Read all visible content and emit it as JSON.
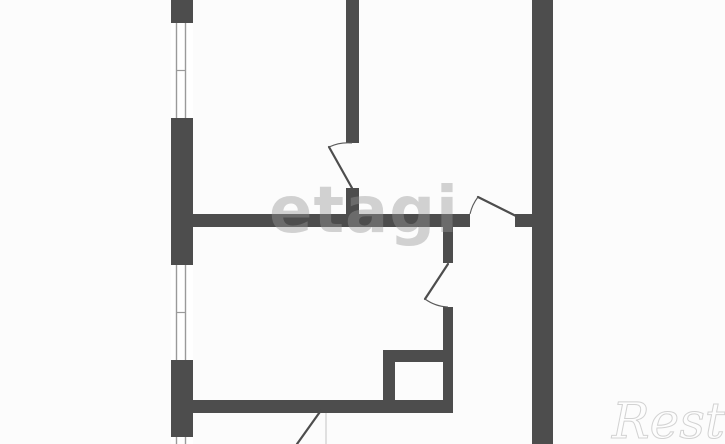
{
  "canvas": {
    "width": 725,
    "height": 444,
    "background": "#fcfcfc"
  },
  "palette": {
    "wall": "#4d4d4d",
    "door": "#4d4d4d",
    "arc": "#5a5a5a",
    "window_fill": "#ffffff",
    "window_glass": "#9a9a9a",
    "faint_line": "#c4c4c4",
    "watermark_center": "rgba(150,150,150,0.42)",
    "watermark_corner_fill": "#fdfdfd",
    "watermark_corner_stroke": "#d2d2d2"
  },
  "watermarks": {
    "center": "etagi",
    "corner": "Restate"
  },
  "floorplan": {
    "walls": [
      {
        "x": 171,
        "y": 0,
        "w": 22,
        "h": 23
      },
      {
        "x": 171,
        "y": 118,
        "w": 22,
        "h": 147
      },
      {
        "x": 171,
        "y": 360,
        "w": 22,
        "h": 77
      },
      {
        "x": 346,
        "y": 0,
        "w": 13,
        "h": 143
      },
      {
        "x": 346,
        "y": 188,
        "w": 13,
        "h": 39
      },
      {
        "x": 532,
        "y": 0,
        "w": 21,
        "h": 444
      },
      {
        "x": 193,
        "y": 214,
        "w": 277,
        "h": 13
      },
      {
        "x": 515,
        "y": 214,
        "w": 17,
        "h": 13
      },
      {
        "x": 443,
        "y": 227,
        "w": 10,
        "h": 36
      },
      {
        "x": 443,
        "y": 307,
        "w": 10,
        "h": 106
      },
      {
        "x": 383,
        "y": 350,
        "w": 12,
        "h": 50
      },
      {
        "x": 383,
        "y": 350,
        "w": 70,
        "h": 12
      },
      {
        "x": 193,
        "y": 400,
        "w": 260,
        "h": 13
      }
    ],
    "windows": [
      {
        "x": 171,
        "y": 23,
        "w": 22,
        "h": 95
      },
      {
        "x": 171,
        "y": 265,
        "w": 22,
        "h": 95
      },
      {
        "x": 171,
        "y": 437,
        "w": 22,
        "h": 7
      }
    ],
    "glass_offsets": [
      5.5,
      14.5
    ],
    "door_leaves": [
      {
        "x1": 352,
        "y1": 188,
        "x2": 329,
        "y2": 147
      },
      {
        "x1": 516,
        "y1": 216,
        "x2": 478,
        "y2": 197
      },
      {
        "x1": 448,
        "y1": 264,
        "x2": 425,
        "y2": 299
      },
      {
        "x1": 322,
        "y1": 409,
        "x2": 297,
        "y2": 444
      }
    ],
    "door_arcs": [
      {
        "d": "M 329,147 A 45,45 0 0 1 352,143"
      },
      {
        "d": "M 478,197 A 44,44 0 0 0 470,214"
      },
      {
        "d": "M 425,299 A 42,42 0 0 0 448,307"
      }
    ],
    "faint_lines": [
      {
        "x1": 326,
        "y1": 413,
        "x2": 326,
        "y2": 444
      }
    ]
  }
}
